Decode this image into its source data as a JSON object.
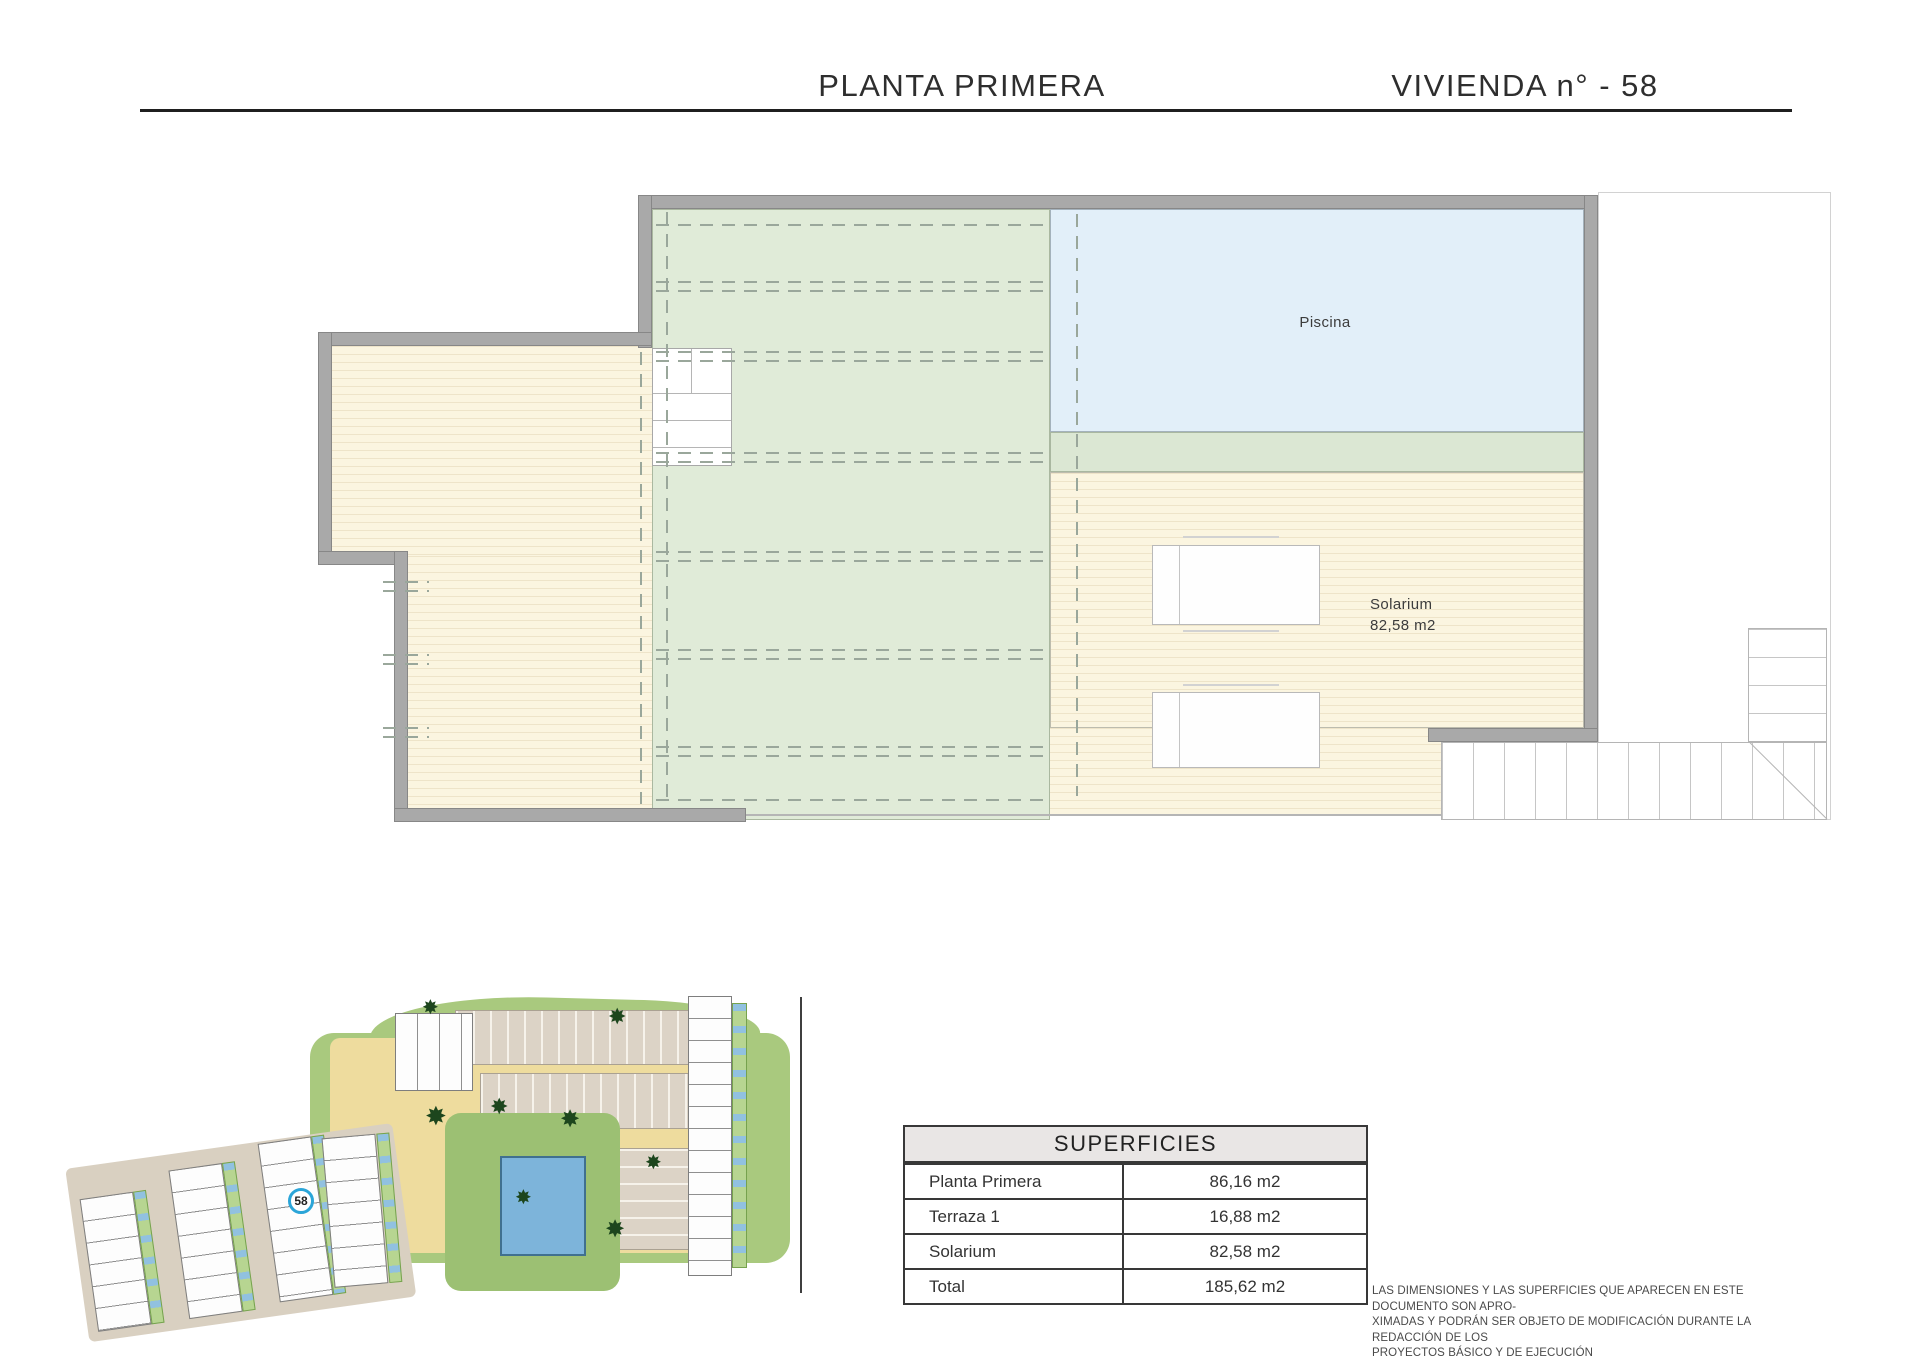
{
  "header": {
    "left_title": "PLANTA PRIMERA",
    "right_title": "VIVIENDA n° - 58"
  },
  "plan": {
    "pool_label": "Piscina",
    "solarium_label": "Solarium",
    "solarium_area": "82,58 m2"
  },
  "site_plan": {
    "unit_marker": "58"
  },
  "surfaces_table": {
    "title": "SUPERFICIES",
    "rows": [
      {
        "label": "Planta Primera",
        "value": "86,16 m2"
      },
      {
        "label": "Terraza 1",
        "value": "16,88 m2"
      },
      {
        "label": "Solarium",
        "value": "82,58 m2"
      },
      {
        "label": "Total",
        "value": "185,62 m2"
      }
    ]
  },
  "disclaimer": {
    "line1": "LAS DIMENSIONES Y LAS SUPERFICIES QUE APARECEN EN ESTE DOCUMENTO SON APRO-",
    "line2": "XIMADAS Y PODRÁN SER OBJETO DE MODIFICACIÓN DURANTE LA REDACCIÓN DE LOS",
    "line3": "PROYECTOS BÁSICO Y DE EJECUCIÓN"
  },
  "colors": {
    "wall_gray": "#a9a9a9",
    "pool_blue": "#e2eff9",
    "roof_green": "#e0ebd8",
    "deck_cream": "#fbf5e0",
    "marker_blue": "#2ba5d8",
    "site_green": "#a9c97e"
  }
}
